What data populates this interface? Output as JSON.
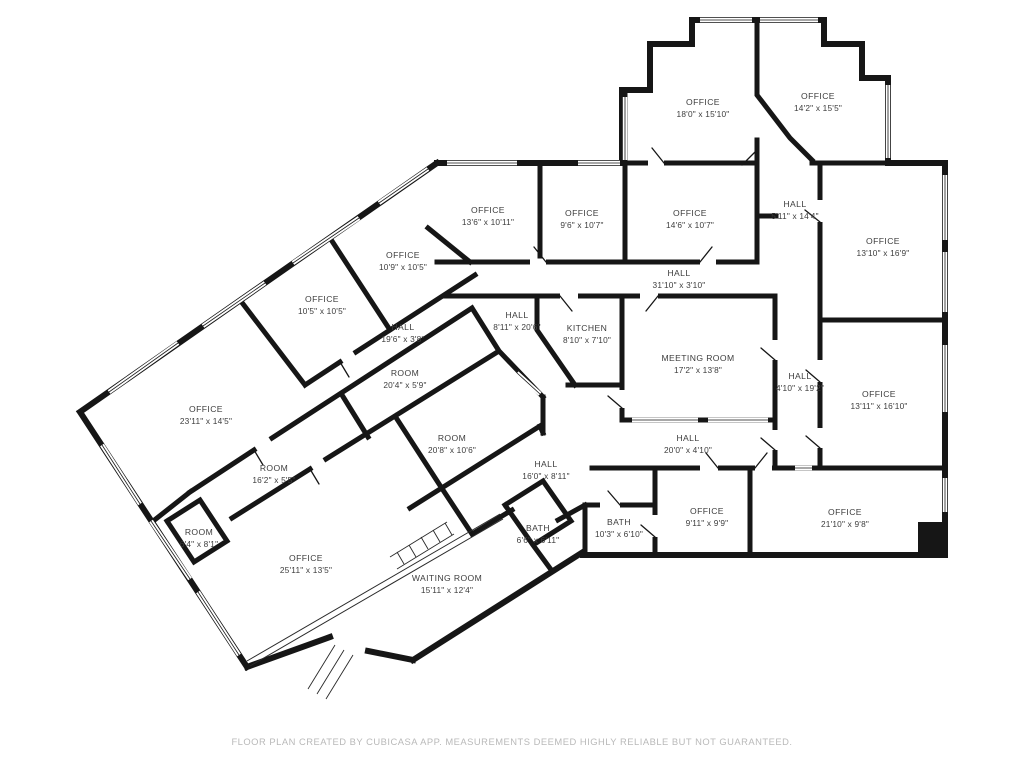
{
  "page": {
    "background": "#ffffff"
  },
  "floor_plan": {
    "wall_color": "#161616",
    "label_color": "#3d3d3d",
    "window_color": "#ffffff",
    "rooms": [
      {
        "name": "OFFICE",
        "dims": "18'0\" x 15'10\"",
        "x": 703,
        "y": 107
      },
      {
        "name": "OFFICE",
        "dims": "14'2\" x 15'5\"",
        "x": 818,
        "y": 101
      },
      {
        "name": "OFFICE",
        "dims": "13'6\" x 10'11\"",
        "x": 488,
        "y": 215
      },
      {
        "name": "OFFICE",
        "dims": "9'6\" x 10'7\"",
        "x": 582,
        "y": 218
      },
      {
        "name": "OFFICE",
        "dims": "14'6\" x 10'7\"",
        "x": 690,
        "y": 218
      },
      {
        "name": "HALL",
        "dims": "5'11\" x 14'4\"",
        "x": 795,
        "y": 209
      },
      {
        "name": "OFFICE",
        "dims": "13'10\" x 16'9\"",
        "x": 883,
        "y": 246
      },
      {
        "name": "OFFICE",
        "dims": "10'9\" x 10'5\"",
        "x": 403,
        "y": 260
      },
      {
        "name": "OFFICE",
        "dims": "10'5\" x 10'5\"",
        "x": 322,
        "y": 304
      },
      {
        "name": "HALL",
        "dims": "31'10\" x 3'10\"",
        "x": 679,
        "y": 278
      },
      {
        "name": "HALL",
        "dims": "19'6\" x 3'8\"",
        "x": 403,
        "y": 332
      },
      {
        "name": "HALL",
        "dims": "8'11\" x 20'6\"",
        "x": 517,
        "y": 320
      },
      {
        "name": "KITCHEN",
        "dims": "8'10\" x 7'10\"",
        "x": 587,
        "y": 333
      },
      {
        "name": "MEETING ROOM",
        "dims": "17'2\" x 13'8\"",
        "x": 698,
        "y": 363
      },
      {
        "name": "HALL",
        "dims": "4'10\" x 19'2\"",
        "x": 800,
        "y": 381
      },
      {
        "name": "OFFICE",
        "dims": "13'11\" x 16'10\"",
        "x": 879,
        "y": 399
      },
      {
        "name": "ROOM",
        "dims": "20'4\" x 5'9\"",
        "x": 405,
        "y": 378
      },
      {
        "name": "OFFICE",
        "dims": "23'11\" x 14'5\"",
        "x": 206,
        "y": 414
      },
      {
        "name": "ROOM",
        "dims": "20'8\" x 10'6\"",
        "x": 452,
        "y": 443
      },
      {
        "name": "HALL",
        "dims": "20'0\" x 4'10\"",
        "x": 688,
        "y": 443
      },
      {
        "name": "ROOM",
        "dims": "16'2\" x 5'5\"",
        "x": 274,
        "y": 473
      },
      {
        "name": "HALL",
        "dims": "16'0\" x 8'11\"",
        "x": 546,
        "y": 469
      },
      {
        "name": "ROOM",
        "dims": "6'4\" x 8'1\"",
        "x": 199,
        "y": 537
      },
      {
        "name": "BATH",
        "dims": "6'6\" x 6'11\"",
        "x": 538,
        "y": 533
      },
      {
        "name": "BATH",
        "dims": "10'3\" x 6'10\"",
        "x": 619,
        "y": 527
      },
      {
        "name": "OFFICE",
        "dims": "9'11\" x 9'9\"",
        "x": 707,
        "y": 516
      },
      {
        "name": "OFFICE",
        "dims": "21'10\" x 9'8\"",
        "x": 845,
        "y": 517
      },
      {
        "name": "OFFICE",
        "dims": "25'11\" x 13'5\"",
        "x": 306,
        "y": 563
      },
      {
        "name": "WAITING ROOM",
        "dims": "15'11\" x 12'4\"",
        "x": 447,
        "y": 583
      }
    ],
    "footer": {
      "text": "FLOOR PLAN CREATED BY CUBICASA APP. MEASUREMENTS DEEMED HIGHLY RELIABLE BUT NOT GUARANTEED.",
      "color": "#b9b9b9"
    }
  }
}
